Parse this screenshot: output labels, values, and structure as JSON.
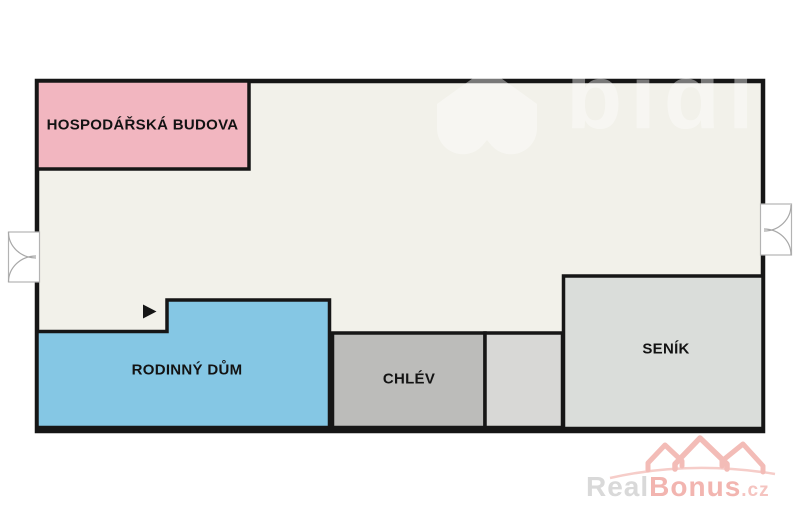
{
  "plan": {
    "colors": {
      "background": "#FFFFFF",
      "yard": "#F2F1EA",
      "outline": "#161616",
      "door_symbol": "#A8A8A8"
    },
    "rooms": [
      {
        "id": "hospodarska-budova",
        "label": "HOSPODÁŘSKÁ BUDOVA",
        "color": "#F2B6C0"
      },
      {
        "id": "rodinny-dum",
        "label": "RODINNÝ DŮM",
        "color": "#85C7E4"
      },
      {
        "id": "chlev",
        "label": "CHLÉV",
        "color": "#BCBCBA"
      },
      {
        "id": "pristavek-bez-popisku",
        "color": "#D8D8D6"
      },
      {
        "id": "senik",
        "label": "SENÍK",
        "color": "#DADDDA"
      }
    ]
  },
  "watermarks": {
    "bidli": {
      "text": "bidli",
      "color": "#FFFFFF"
    },
    "realbonus": {
      "brand_gray": "Real",
      "brand_red": "Bonus",
      "tld": ".cz",
      "gray_color": "#D9D9D9",
      "red_color": "#F2B5B0",
      "tld_color": "#F5C4C0",
      "roof_color": "#F3BCB7"
    }
  }
}
